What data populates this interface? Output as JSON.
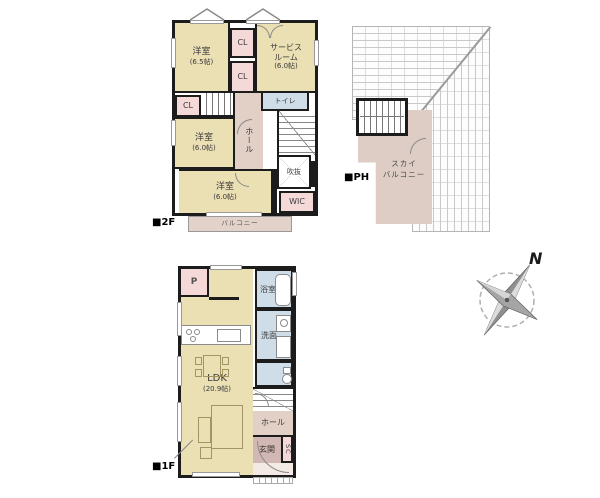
{
  "f2": {
    "label": "■2F",
    "room_main1": {
      "name": "洋室",
      "size": "(6.5帖)"
    },
    "closet1": "CL",
    "closet2": "CL",
    "service_room": {
      "name": "サービス\nルーム",
      "size": "(6.0帖)"
    },
    "closet3": "CL",
    "hall": "ホール",
    "toilet": "トイレ",
    "room_main2": {
      "name": "洋室",
      "size": "(6.0帖)"
    },
    "void": "吹抜",
    "room_main3": {
      "name": "洋室",
      "size": "(6.0帖)"
    },
    "wic": "WIC",
    "balcony": "バルコニー"
  },
  "ph": {
    "label": "■PH",
    "sky_balcony": "スカイ\nバルコニー"
  },
  "f1": {
    "label": "■1F",
    "pantry": "P",
    "bath": "浴室",
    "washroom": "洗面",
    "ldk": {
      "name": "LDK",
      "size": "(20.9帖)"
    },
    "hall": "ホール",
    "entrance": "玄関",
    "shoe_closet": "SC"
  },
  "compass": {
    "north": "N"
  },
  "colors": {
    "room_beige": "#ebdfb4",
    "corridor_pink": "#e2d0c7",
    "closet_pink": "#f5d9d9",
    "wet_area_blue": "#cfdde8",
    "balcony_tan": "#e2d2ca",
    "entrance_mauve": "#d2b8b4",
    "sky_balcony_tan": "#ddcdc5",
    "wall_black": "#1c1c1c"
  }
}
